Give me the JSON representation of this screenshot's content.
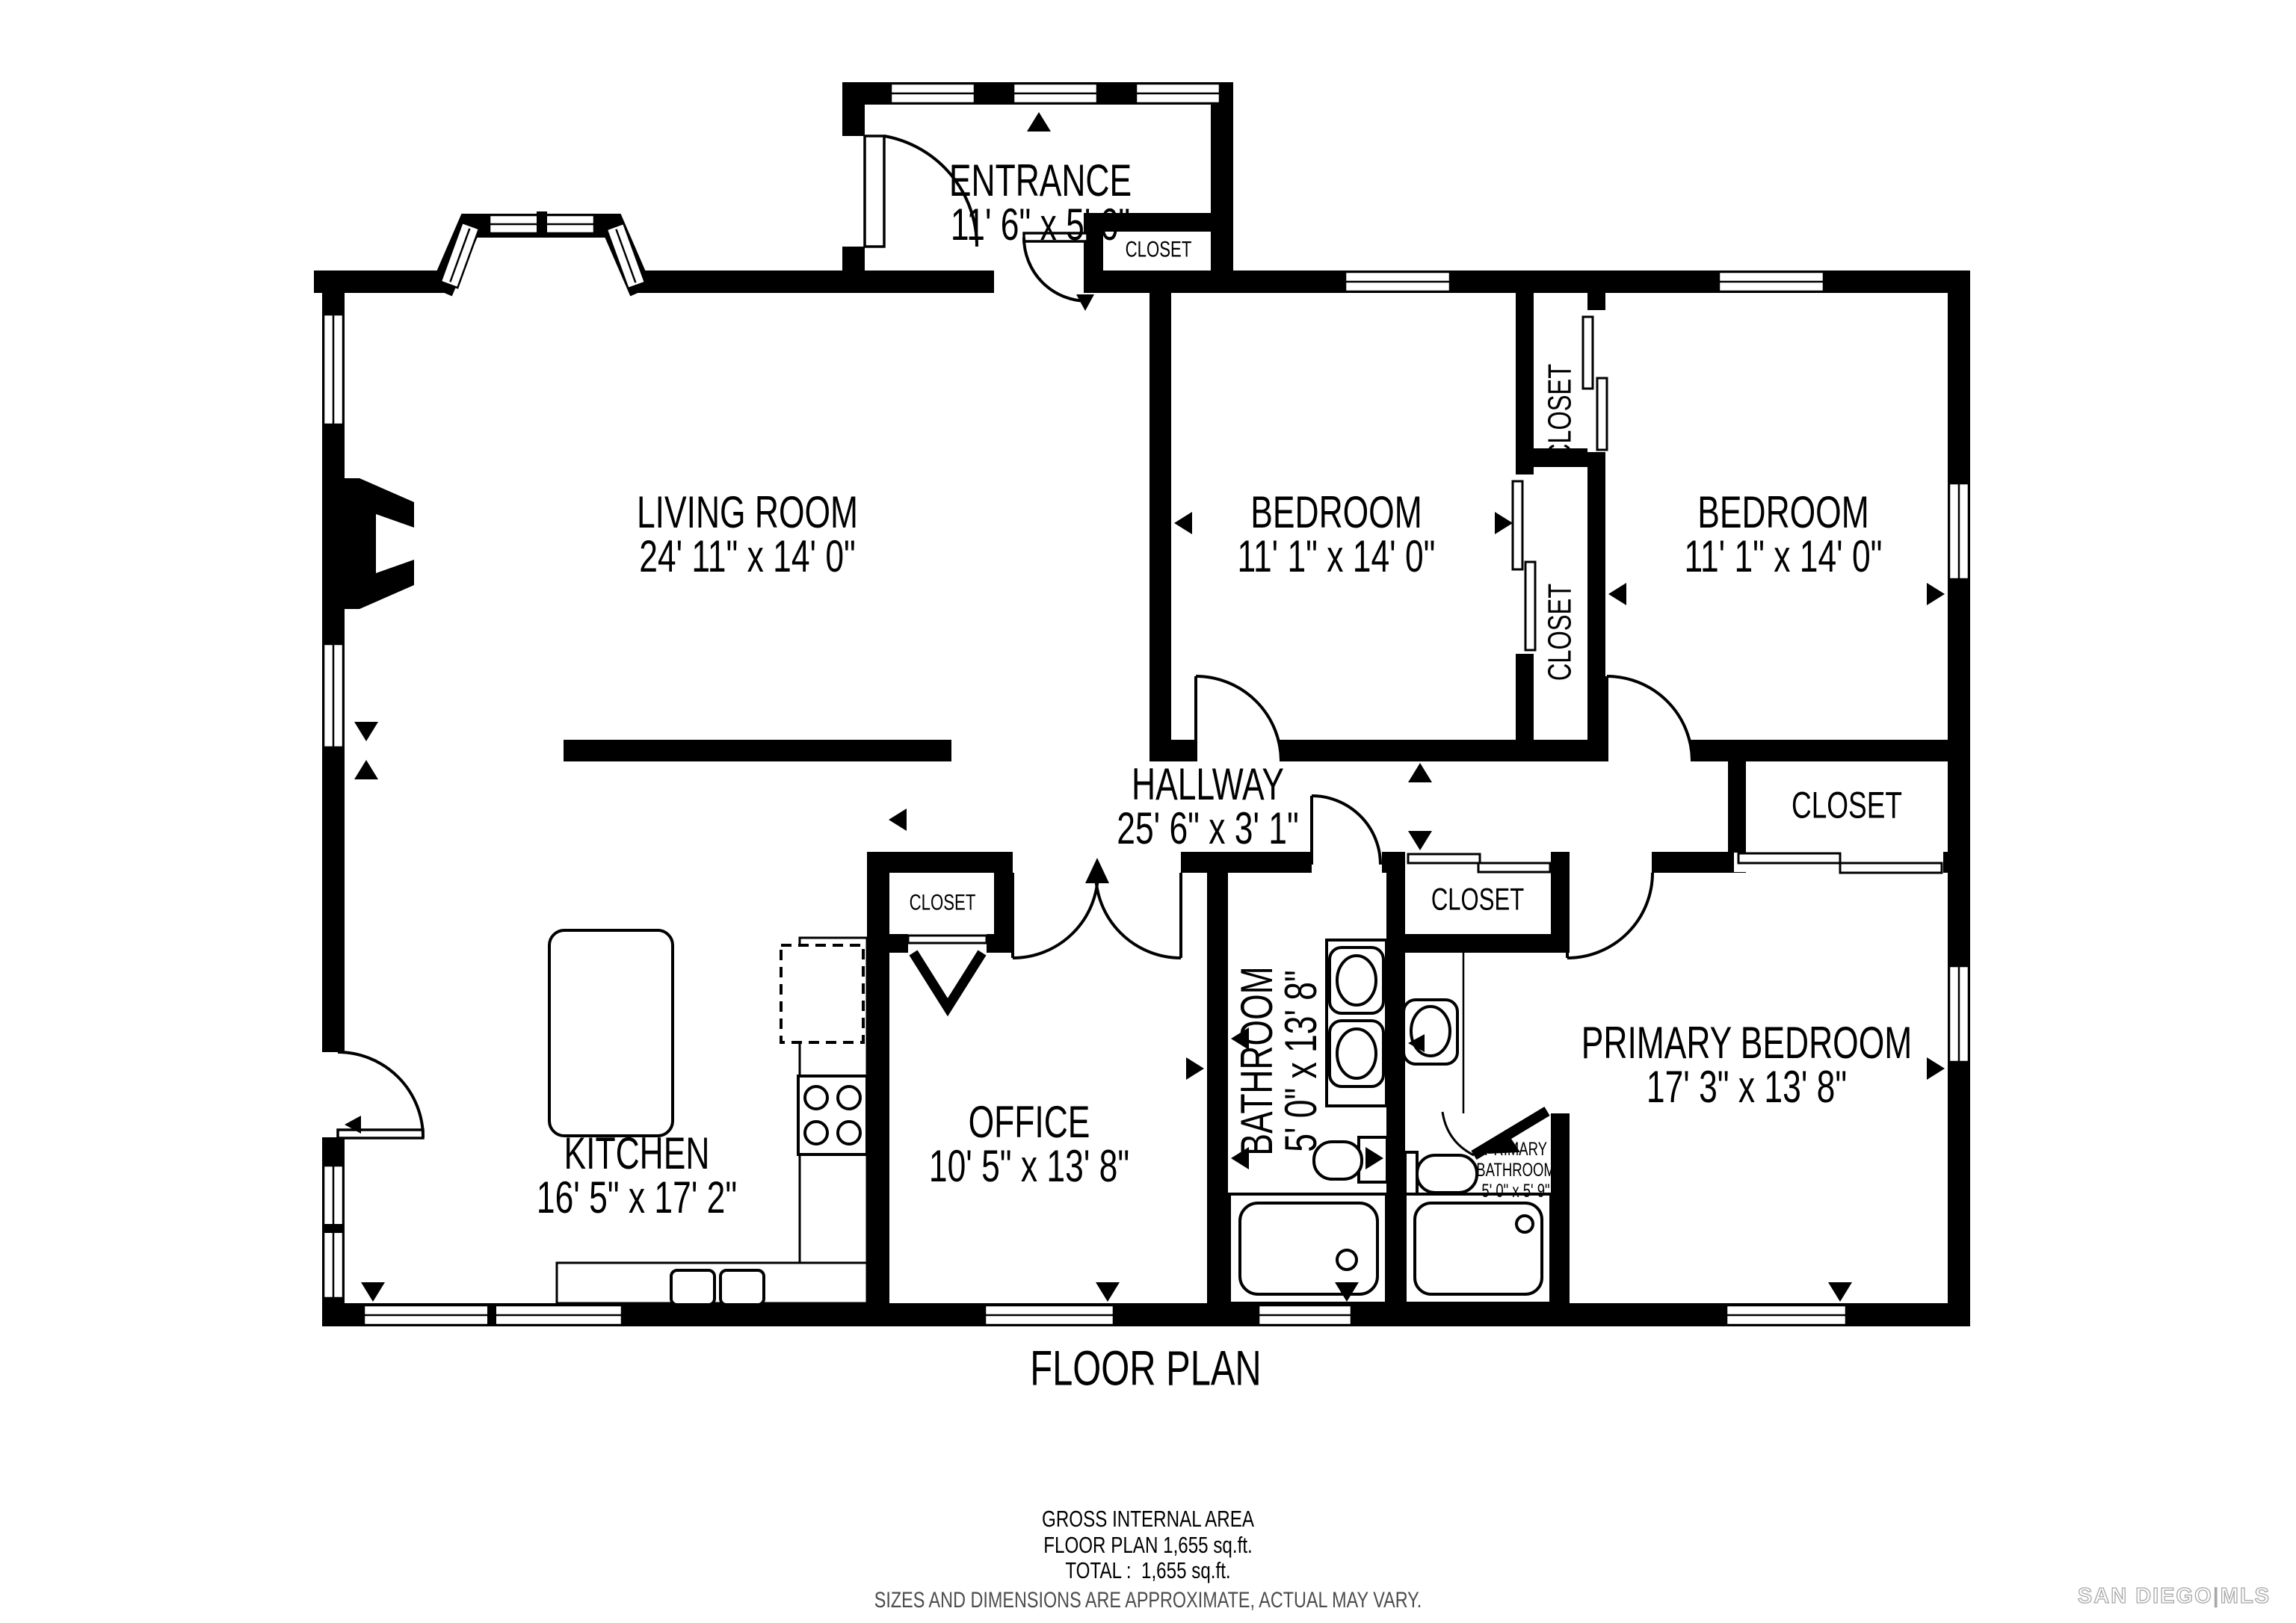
{
  "page": {
    "title": "FLOOR PLAN"
  },
  "rooms": {
    "entrance": {
      "name": "ENTRANCE",
      "dims": "11' 6\" x 5' 6\""
    },
    "living_room": {
      "name": "LIVING ROOM",
      "dims": "24' 11\" x 14' 0\""
    },
    "bedroom_left": {
      "name": "BEDROOM",
      "dims": "11' 1\" x 14' 0\""
    },
    "bedroom_right": {
      "name": "BEDROOM",
      "dims": "11' 1\" x 14' 0\""
    },
    "hallway": {
      "name": "HALLWAY",
      "dims": "25' 6\" x 3' 1\""
    },
    "kitchen": {
      "name": "KITCHEN",
      "dims": "16' 5\" x 17' 2\""
    },
    "office": {
      "name": "OFFICE",
      "dims": "10' 5\" x 13' 8\""
    },
    "bathroom": {
      "name": "BATHROOM",
      "dims": "5' 0\" x 13' 8\""
    },
    "primary_bedroom": {
      "name": "PRIMARY BEDROOM",
      "dims": "17' 3\" x 13' 8\""
    },
    "primary_bathroom": {
      "line1": "PRIMARY",
      "line2": "BATHROOM",
      "dims": "5' 0\" x 5' 9\""
    }
  },
  "closets": {
    "entrance_closet": "CLOSET",
    "bedroom_left_closet": "CLOSET",
    "bedroom_right_closet": "CLOSET",
    "hall_closet": "CLOSET",
    "primary_closet": "CLOSET",
    "office_closet": "CLOSET"
  },
  "footer": {
    "gross_area": "GROSS INTERNAL AREA",
    "floor_plan_area": "FLOOR PLAN 1,655 sq.ft.",
    "total_area": "TOTAL :  1,655 sq.ft.",
    "disclaimer": "SIZES AND DIMENSIONS ARE APPROXIMATE, ACTUAL MAY VARY."
  },
  "watermark": {
    "left": "SAN DIEGO",
    "divider": "|",
    "right": "MLS"
  },
  "colors": {
    "wall": "#000000",
    "background": "#ffffff",
    "disclaimer_text": "#4d4d4d",
    "watermark": "#a8a8a8"
  }
}
